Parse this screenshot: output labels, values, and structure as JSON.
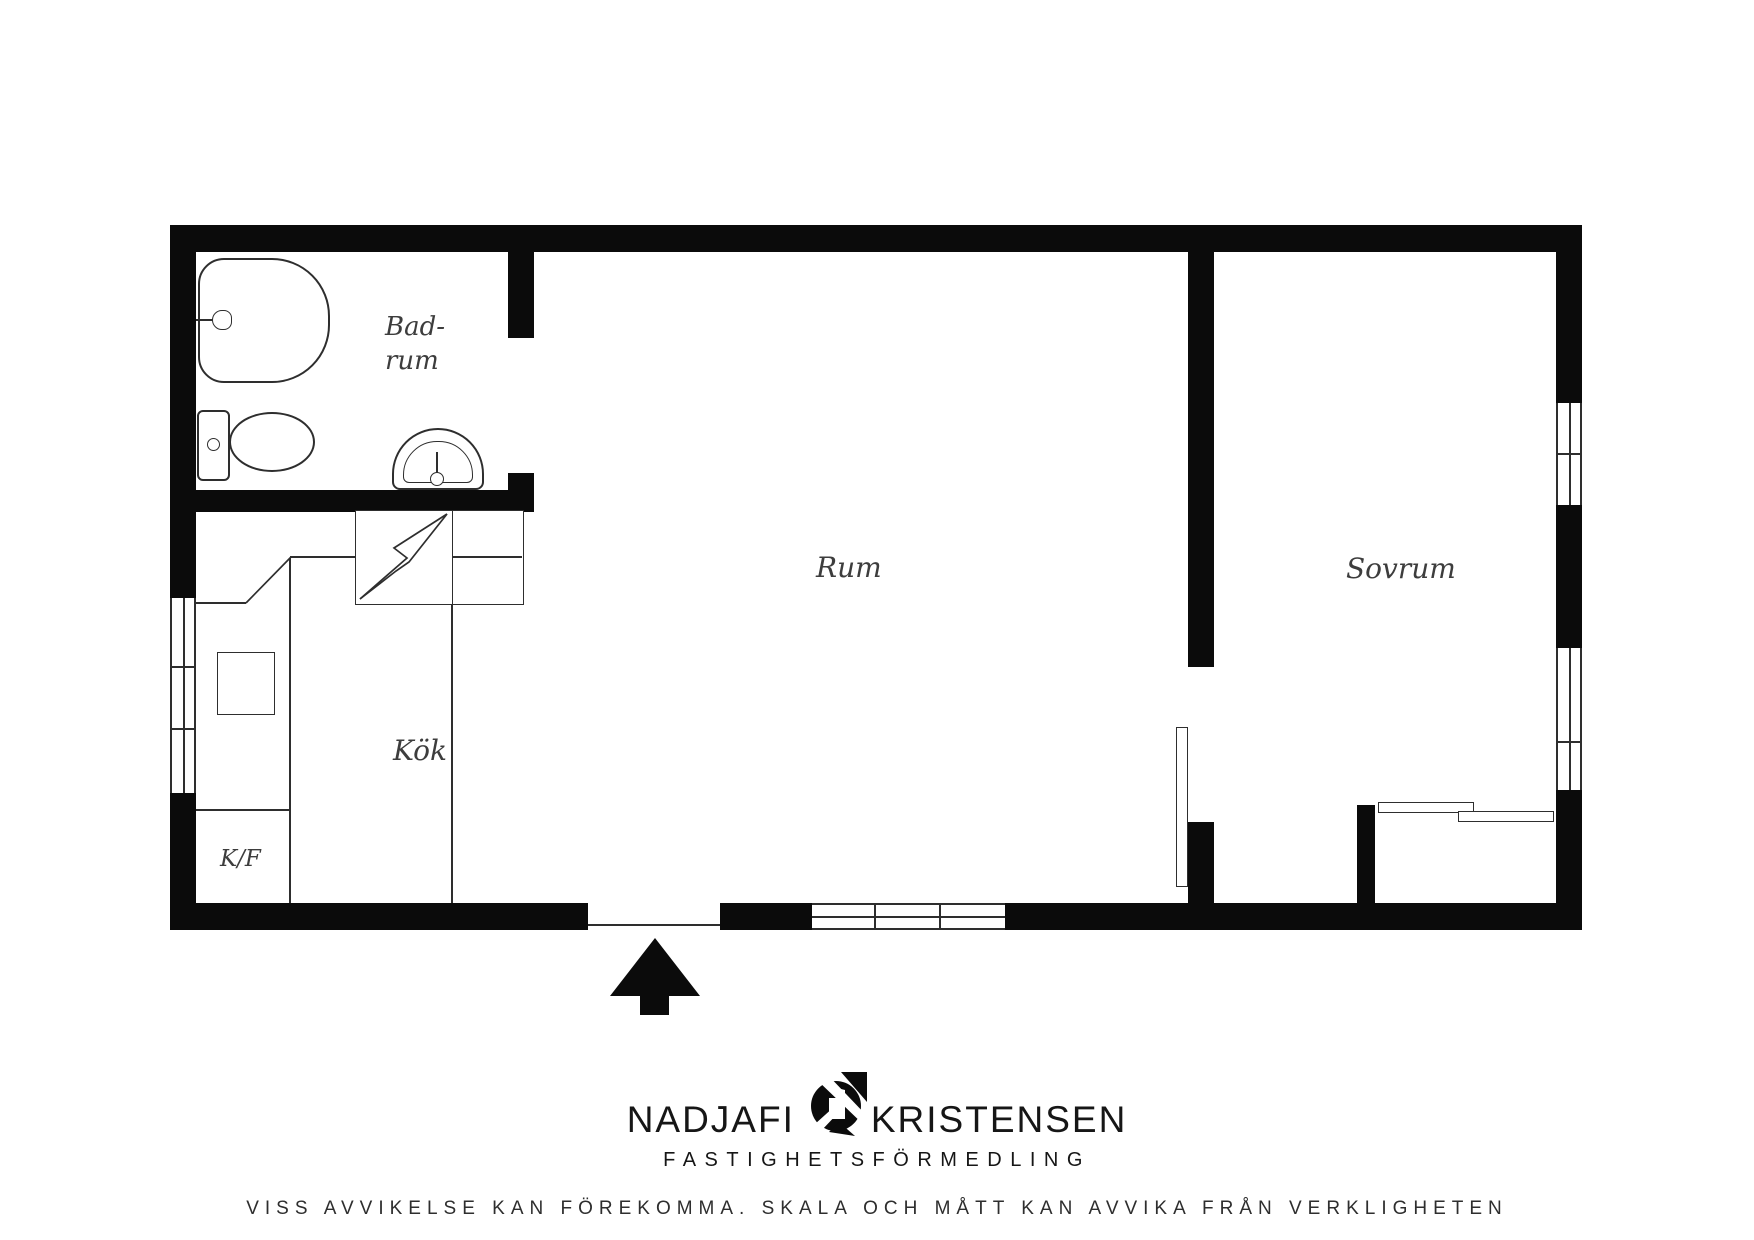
{
  "floorplan": {
    "labels": {
      "bathroom_line1": "Bad-",
      "bathroom_line2": "rum",
      "living_room": "Rum",
      "bedroom": "Sovrum",
      "kitchen": "Kök",
      "fridge_freezer": "K/F"
    },
    "colors": {
      "wall": "#0b0b0b",
      "line": "#2e2e2e",
      "label": "#3d3d3d"
    },
    "icons": {
      "entrance_arrow": "entrance-arrow",
      "stove_symbol": "lightning-bolt",
      "logo_mark": "circle-house-mark"
    }
  },
  "footer": {
    "brand_first": "NADJAFI",
    "brand_second": "KRISTENSEN",
    "brand_subtitle": "FASTIGHETSFÖRMEDLING",
    "disclaimer": "VISS AVVIKELSE KAN FÖREKOMMA. SKALA OCH MÅTT KAN AVVIKA FRÅN VERKLIGHETEN"
  }
}
